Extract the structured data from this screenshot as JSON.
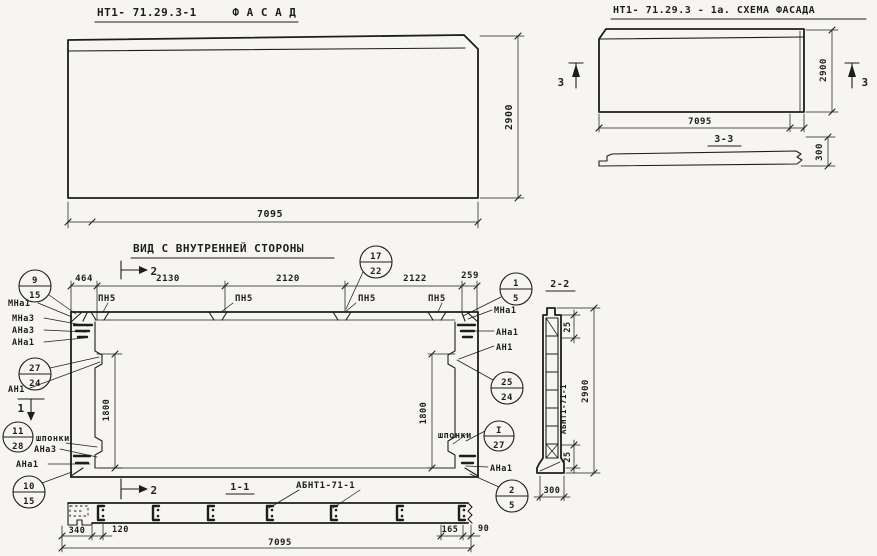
{
  "colors": {
    "ink": "#1d1d1b",
    "paper": "#f6f5f1"
  },
  "facade": {
    "title": "НТ1- 71.29.3-1     Ф А С А Д",
    "dim_width": "7095",
    "dim_height": "2900"
  },
  "schema": {
    "title": "НТ1- 71.29.3 - 1а. СХЕМА ФАСАДА",
    "dim_width": "7095",
    "dim_height": "2900",
    "section_mark_left": "3",
    "section_mark_right": "3",
    "section_title": "3-3",
    "dim_thickness": "300"
  },
  "inner": {
    "title": "ВИД С ВНУТРЕННЕЙ СТОРОНЫ",
    "dims_top": [
      "464",
      "2130",
      "2120",
      "2122",
      "259"
    ],
    "pn_label": "ПН5",
    "dim_1800_left": "1800",
    "dim_1800_right": "1800",
    "shponki_left": "шпонки",
    "shponki_right": "шпонки",
    "labels_left": {
      "l1": "МНа1",
      "l2": "МНа3",
      "l3": "АНа3",
      "l4": "АНа1",
      "l5": "АН1",
      "l6": "АНа3",
      "l7": "АНа1"
    },
    "labels_right": {
      "r1": "МНа1",
      "r2": "АНа1",
      "r3": "АН1",
      "r4": "АНа1"
    },
    "marks": {
      "m9": {
        "t": "9",
        "b": "15"
      },
      "m17": {
        "t": "17",
        "b": "22"
      },
      "m1": {
        "t": "1",
        "b": "5"
      },
      "m27": {
        "t": "27",
        "b": "24"
      },
      "m25": {
        "t": "25",
        "b": "24"
      },
      "m11": {
        "t": "11",
        "b": "28"
      },
      "mI": {
        "t": "I",
        "b": "27"
      },
      "m10": {
        "t": "10",
        "b": "15"
      },
      "m2": {
        "t": "2",
        "b": "5"
      }
    },
    "sec_mark_1": "1",
    "sec_mark_2_top": "2",
    "sec_mark_2_bot": "2"
  },
  "sec11": {
    "title": "1-1",
    "beam_label": "АБНТ1-71-1",
    "dim_340": "340",
    "dim_120": "120",
    "dim_total": "7095",
    "dim_165": "165",
    "dim_90": "90"
  },
  "sec22": {
    "title": "2-2",
    "beam_label": "АБНТ1-71-1",
    "dim_25_top": "25",
    "dim_25_bot": "25",
    "dim_height": "2900",
    "dim_width": "300"
  }
}
